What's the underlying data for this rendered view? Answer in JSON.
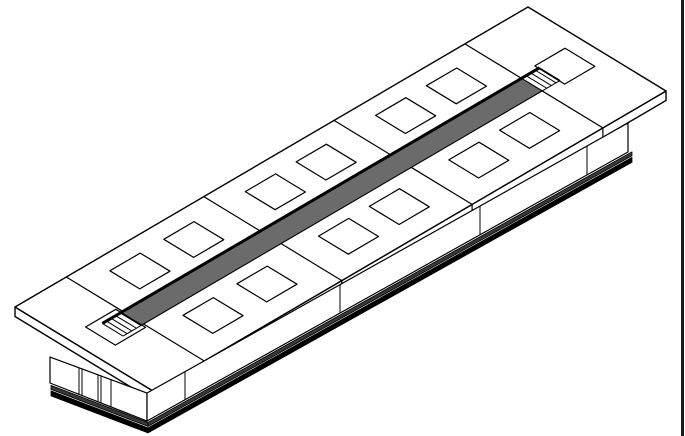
{
  "meta": {
    "description": "Isometric CAD line drawing of a long modular conference table with a dark center cable channel, paired square grommet cutouts, section seams, and a paneled pedestal base with floor plinth. Dark border bar along the right edge of the drawing canvas.",
    "canvas": {
      "width": 685,
      "height": 436,
      "background": "#ffffff"
    }
  },
  "colors": {
    "line": "#000000",
    "paper": "#ffffff",
    "strip_fill": "#6b6b6b",
    "hatch_band": "#383838",
    "plinth": "#000000",
    "frame_bar": "#1a1a1a"
  },
  "frame": {
    "right_bar": {
      "x": 681,
      "width": 3,
      "height": 436
    }
  },
  "drawing": {
    "table": {
      "origin": [
        15,
        307
      ],
      "axis_long": [
        513,
        -300
      ],
      "axis_wide": [
        138,
        84
      ],
      "slab_thickness": 9.5,
      "outline_stroke": 1.4,
      "detail_stroke": 1.2
    },
    "dividers_a": [
      0.1,
      0.368,
      0.622,
      0.877
    ],
    "strip": {
      "a0": 0.095,
      "a1": 0.877,
      "b0": 0.41,
      "b1": 0.56,
      "edge_extend_a": 0.035,
      "edge_width": 3,
      "ramp_lines_a_offsets": [
        0.009,
        0.018,
        0.027,
        0.035
      ]
    },
    "squares": {
      "half_a": 0.0295,
      "half_b": 0.108,
      "centers": [
        [
          0.067,
          0.48
        ],
        [
          0.94,
          0.49
        ],
        [
          0.183,
          0.225
        ],
        [
          0.288,
          0.225
        ],
        [
          0.183,
          0.755
        ],
        [
          0.288,
          0.755
        ],
        [
          0.447,
          0.225
        ],
        [
          0.546,
          0.225
        ],
        [
          0.447,
          0.755
        ],
        [
          0.546,
          0.755
        ],
        [
          0.701,
          0.225
        ],
        [
          0.8,
          0.225
        ],
        [
          0.701,
          0.755
        ],
        [
          0.8,
          0.755
        ]
      ]
    },
    "base": {
      "end_face": {
        "top": [
          [
            50,
            357
          ],
          [
            147,
            393
          ]
        ],
        "bottom": [
          [
            50,
            383
          ],
          [
            147,
            421
          ]
        ],
        "verticals_x": [
          79,
          82,
          98,
          101,
          111
        ]
      },
      "long_face": {
        "top": [
          [
            147,
            393
          ],
          [
            628,
            123
          ]
        ],
        "bottom": [
          [
            147,
            421
          ],
          [
            628,
            152
          ]
        ],
        "verticals_x": [
          185,
          340,
          480,
          587
        ]
      },
      "bands": {
        "hatch_offset": [
          2,
          6
        ],
        "plinth_offset": [
          7.5,
          12.5
        ],
        "long_x_end": 632,
        "end_x_start": 51,
        "corner_x": 148
      }
    }
  }
}
